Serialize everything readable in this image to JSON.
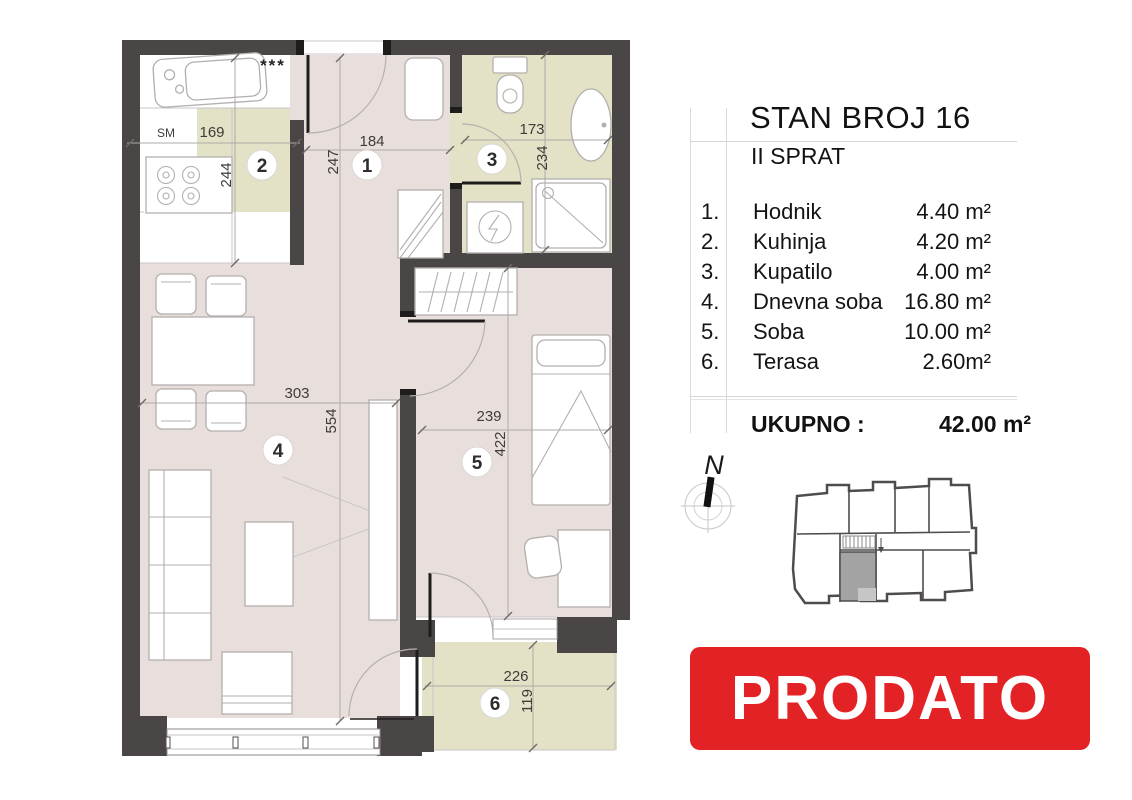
{
  "legend": {
    "title": "STAN BROJ 16",
    "subtitle": "II SPRAT",
    "rooms": [
      {
        "num": "1.",
        "name": "Hodnik",
        "area": "4.40 m²"
      },
      {
        "num": "2.",
        "name": "Kuhinja",
        "area": "4.20 m²"
      },
      {
        "num": "3.",
        "name": "Kupatilo",
        "area": "4.00 m²"
      },
      {
        "num": "4.",
        "name": "Dnevna soba",
        "area": "16.80 m²"
      },
      {
        "num": "5.",
        "name": "Soba",
        "area": "10.00 m²"
      },
      {
        "num": "6.",
        "name": "Terasa",
        "area": "2.60m²"
      }
    ],
    "total_label": "UKUPNO :",
    "total_value": "42.00 m²"
  },
  "compass": {
    "north_label": "N"
  },
  "status_banner": {
    "text": "PRODATO",
    "color": "#e32226"
  },
  "floor_plan": {
    "room_numbers": [
      "1",
      "2",
      "3",
      "4",
      "5",
      "6"
    ],
    "dimensions": {
      "hodnik": {
        "w": "184",
        "h": "247"
      },
      "kuhinja": {
        "w": "169",
        "h": "244"
      },
      "kupatilo": {
        "w": "173",
        "h": "234"
      },
      "dnevna_soba": {
        "w": "303",
        "h": "554"
      },
      "soba": {
        "w": "239",
        "h": "422"
      },
      "terasa": {
        "w": "226",
        "h": "119"
      }
    },
    "labels": {
      "washing_machine": "SM",
      "stars": "***"
    },
    "colors": {
      "wall": "#4a4645",
      "floor_living": "#e8dfdc",
      "floor_tiles": "#e4e2c6"
    }
  }
}
